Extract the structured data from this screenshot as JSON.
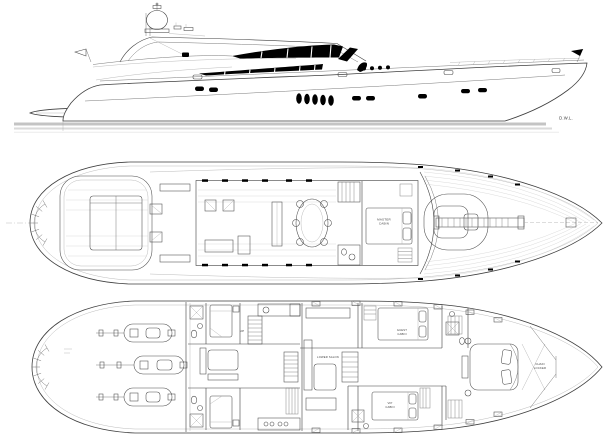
{
  "colors": {
    "line": "#3f3f3f",
    "light_line": "#a9a9a9",
    "glazing_fill": "#000000",
    "waterline_band": "#c4c4c4",
    "background": "#ffffff"
  },
  "profile": {
    "dwl_label": "D.W.L."
  },
  "main_deck": {
    "master_cabin_line1": "MASTER",
    "master_cabin_line2": "CABIN"
  },
  "lower_deck": {
    "up_label": "UP",
    "lower_salon_label": "LOWER SALON",
    "guest_cabin_line1": "GUEST",
    "guest_cabin_line2": "CABIN",
    "vip_cabin_line1": "VIP",
    "vip_cabin_line2": "CABIN",
    "chain_locker_line1": "CHAIN",
    "chain_locker_line2": "LOCKER"
  }
}
